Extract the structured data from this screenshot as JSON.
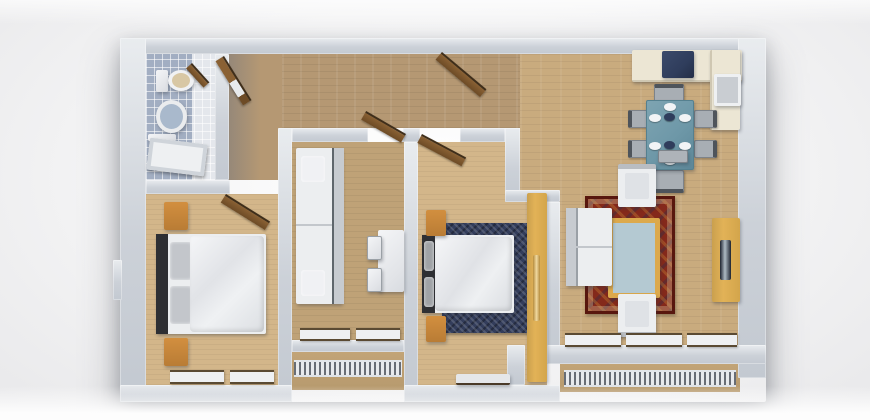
{
  "scene": {
    "name": "3d-apartment-floor-plan",
    "view": "top-down-3d-render",
    "rooms": [
      {
        "id": "bathroom",
        "furniture": [
          "toilet",
          "wash-basin",
          "bathtub",
          "door"
        ]
      },
      {
        "id": "hallway",
        "furniture": [
          "entry-door",
          "closet-door"
        ]
      },
      {
        "id": "bedroom-left",
        "furniture": [
          "double-bed",
          "nightstand-top",
          "nightstand-bottom",
          "window",
          "door"
        ]
      },
      {
        "id": "lounge-middle",
        "furniture": [
          "sofa",
          "wall-desk",
          "chair",
          "chair",
          "windows",
          "door"
        ]
      },
      {
        "id": "bedroom-right",
        "furniture": [
          "double-bed",
          "navy-rug",
          "nightstand-top",
          "nightstand-bottom",
          "wardrobe",
          "bench",
          "door"
        ]
      },
      {
        "id": "living-dining",
        "furniture": [
          "kitchen-counter",
          "cooktop",
          "kitchen-sink",
          "dining-table",
          "dining-chairs-x6",
          "plates",
          "red-oriental-rug",
          "coffee-table",
          "sofa",
          "armchair-top",
          "armchair-bottom",
          "tv-console",
          "wall-shelf",
          "windows",
          "balcony-railing"
        ]
      }
    ]
  },
  "colors": {
    "wall": "#ccd1d8",
    "floor_hall": "#b59873",
    "floor_living": "#c9ab7e",
    "floor_bedroom": "#d3b68a",
    "floor_lounge": "#bfa277",
    "balcony_face": "#c2a477",
    "tile_blue": "#a2aec2",
    "tile_white": "#e4e7ec",
    "rug_red": "#84291b",
    "rug_red_dark": "#58170e",
    "rug_navy": "#333d5b",
    "wood_accent": "#d28f3f",
    "wardrobe_yellow": "#e2b257",
    "counter_cream": "#ece6d4",
    "cooktop_navy": "#2f3d5c",
    "sink_gray": "#c9cdd2",
    "table_teal": "#6e98a8",
    "chair_gray": "#a8aeb4",
    "door_brown": "#8a6134",
    "glass_blue": "#b4c9d2",
    "frame_gold": "#dca94c",
    "headboard_dark": "#2e2f33",
    "sofa_white": "#eceef0"
  }
}
